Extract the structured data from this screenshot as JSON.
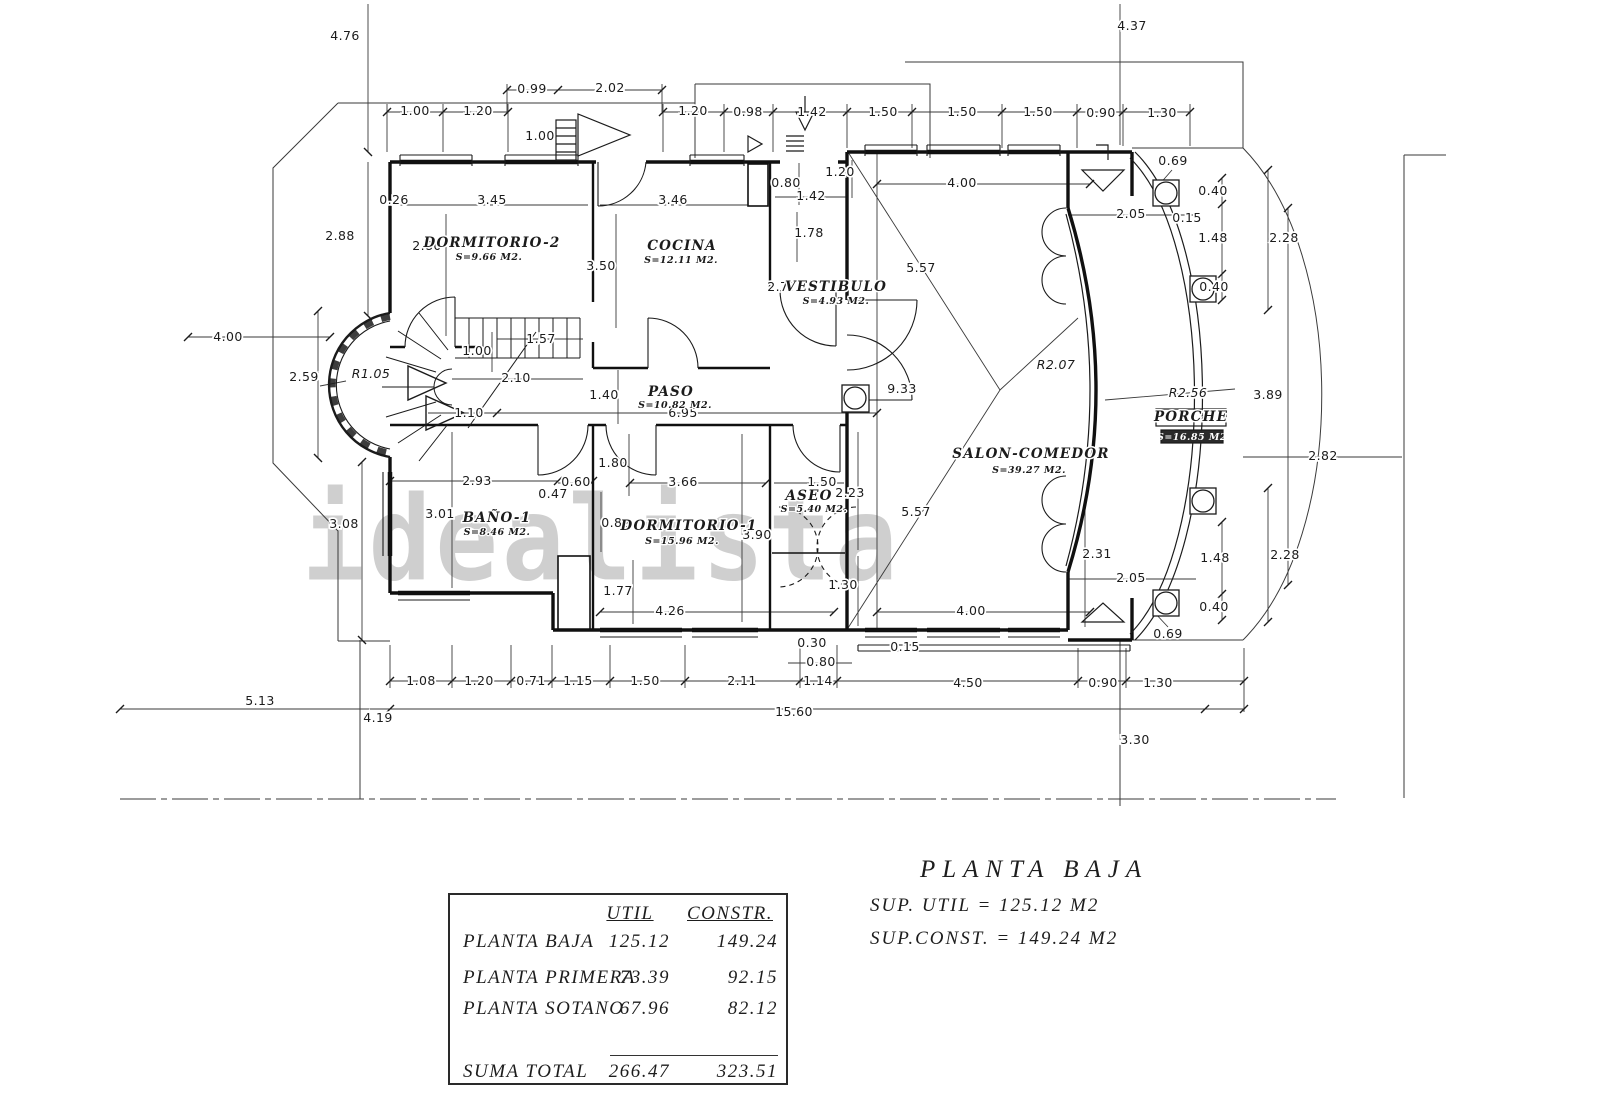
{
  "watermark": "idealista",
  "title_block": {
    "title": "PLANTA BAJA",
    "sup_util": "SUP. UTIL = 125.12 M2",
    "sup_const": "SUP.CONST. = 149.24 M2"
  },
  "summary_table": {
    "headers": {
      "util": "UTIL",
      "constr": "CONSTR."
    },
    "rows": [
      {
        "label": "PLANTA BAJA",
        "util": "125.12",
        "constr": "149.24"
      },
      {
        "label": "PLANTA PRIMERA",
        "util": "73.39",
        "constr": "92.15"
      },
      {
        "label": "PLANTA SOTANO",
        "util": "67.96",
        "constr": "82.12"
      }
    ],
    "total": {
      "label": "SUMA TOTAL",
      "util": "266.47",
      "constr": "323.51"
    }
  },
  "rooms": [
    {
      "name": "DORMITORIO-2",
      "area": "S=9.66 M2.",
      "x": 492,
      "y": 247,
      "ax": 489,
      "ay": 260
    },
    {
      "name": "COCINA",
      "area": "S=12.11 M2.",
      "x": 682,
      "y": 250,
      "ax": 681,
      "ay": 263
    },
    {
      "name": "VESTIBULO",
      "area": "S=4.93 M2.",
      "x": 836,
      "y": 291,
      "ax": 836,
      "ay": 304
    },
    {
      "name": "PASO",
      "area": "S=10.82 M2.",
      "x": 671,
      "y": 396,
      "ax": 675,
      "ay": 408
    },
    {
      "name": "BAÑO-1",
      "area": "S=8.46 M2.",
      "x": 497,
      "y": 522,
      "ax": 497,
      "ay": 535
    },
    {
      "name": "DORMITORIO-1",
      "area": "S=15.96 M2.",
      "x": 689,
      "y": 530,
      "ax": 682,
      "ay": 544
    },
    {
      "name": "ASEO",
      "area": "S=5.40 M2.",
      "x": 809,
      "y": 500,
      "ax": 814,
      "ay": 512
    },
    {
      "name": "SALON-COMEDOR",
      "area": "S=39.27 M2.",
      "x": 1031,
      "y": 458,
      "ax": 1029,
      "ay": 473
    },
    {
      "name": "PORCHE",
      "area": "S=16.85 M2",
      "x": 1191,
      "y": 421,
      "ax": 1192,
      "ay": 440
    }
  ],
  "annotations": [
    {
      "t": "R1.05",
      "x": 371,
      "y": 378
    },
    {
      "t": "R2.07",
      "x": 1056,
      "y": 369
    },
    {
      "t": "R2.56",
      "x": 1188,
      "y": 397
    }
  ],
  "dimensions": [
    {
      "t": "4.76",
      "x": 345,
      "y": 40
    },
    {
      "t": "4.37",
      "x": 1132,
      "y": 30
    },
    {
      "t": "0.99",
      "x": 532,
      "y": 93
    },
    {
      "t": "2.02",
      "x": 610,
      "y": 92
    },
    {
      "t": "1.00",
      "x": 415,
      "y": 115
    },
    {
      "t": "1.20",
      "x": 478,
      "y": 115
    },
    {
      "t": "1.20",
      "x": 693,
      "y": 115
    },
    {
      "t": "0.98",
      "x": 748,
      "y": 116
    },
    {
      "t": "1.42",
      "x": 812,
      "y": 116
    },
    {
      "t": "1.50",
      "x": 883,
      "y": 116
    },
    {
      "t": "1.50",
      "x": 962,
      "y": 116
    },
    {
      "t": "1.50",
      "x": 1038,
      "y": 116
    },
    {
      "t": "0.90",
      "x": 1101,
      "y": 117
    },
    {
      "t": "1.30",
      "x": 1162,
      "y": 117
    },
    {
      "t": "1.00",
      "x": 540,
      "y": 140
    },
    {
      "t": "0.80",
      "x": 786,
      "y": 187
    },
    {
      "t": "1.20",
      "x": 840,
      "y": 176
    },
    {
      "t": "1.42",
      "x": 811,
      "y": 200
    },
    {
      "t": "1.78",
      "x": 809,
      "y": 237
    },
    {
      "t": "2.77",
      "x": 782,
      "y": 291
    },
    {
      "t": "0.26",
      "x": 394,
      "y": 204
    },
    {
      "t": "3.45",
      "x": 492,
      "y": 204
    },
    {
      "t": "3.46",
      "x": 673,
      "y": 204
    },
    {
      "t": "2.80",
      "x": 427,
      "y": 250
    },
    {
      "t": "3.50",
      "x": 601,
      "y": 270
    },
    {
      "t": "2.88",
      "x": 340,
      "y": 240
    },
    {
      "t": "4.00",
      "x": 228,
      "y": 341
    },
    {
      "t": "2.59",
      "x": 304,
      "y": 381
    },
    {
      "t": "3.08",
      "x": 344,
      "y": 528
    },
    {
      "t": "1.57",
      "x": 541,
      "y": 343
    },
    {
      "t": "2.10",
      "x": 516,
      "y": 382
    },
    {
      "t": "1.00",
      "x": 477,
      "y": 355
    },
    {
      "t": "1.10",
      "x": 469,
      "y": 417
    },
    {
      "t": "1.40",
      "x": 604,
      "y": 399
    },
    {
      "t": "6.95",
      "x": 683,
      "y": 417
    },
    {
      "t": "9.33",
      "x": 902,
      "y": 393
    },
    {
      "t": "4.00",
      "x": 962,
      "y": 187
    },
    {
      "t": "4.00",
      "x": 971,
      "y": 615
    },
    {
      "t": "5.57",
      "x": 921,
      "y": 272
    },
    {
      "t": "5.57",
      "x": 916,
      "y": 516
    },
    {
      "t": "2.93",
      "x": 477,
      "y": 485
    },
    {
      "t": "0.60",
      "x": 576,
      "y": 486
    },
    {
      "t": "0.47",
      "x": 553,
      "y": 498
    },
    {
      "t": "3.01",
      "x": 440,
      "y": 518
    },
    {
      "t": "0.82",
      "x": 616,
      "y": 527
    },
    {
      "t": "1.80",
      "x": 613,
      "y": 467
    },
    {
      "t": "3.66",
      "x": 683,
      "y": 486
    },
    {
      "t": "3.90",
      "x": 757,
      "y": 539
    },
    {
      "t": "1.50",
      "x": 822,
      "y": 486
    },
    {
      "t": "2.23",
      "x": 850,
      "y": 497
    },
    {
      "t": "1.30",
      "x": 843,
      "y": 589
    },
    {
      "t": "1.77",
      "x": 618,
      "y": 595
    },
    {
      "t": "4.26",
      "x": 670,
      "y": 615
    },
    {
      "t": "0.30",
      "x": 812,
      "y": 647
    },
    {
      "t": "0.80",
      "x": 821,
      "y": 666
    },
    {
      "t": "0.15",
      "x": 905,
      "y": 651
    },
    {
      "t": "1.08",
      "x": 421,
      "y": 685
    },
    {
      "t": "1.20",
      "x": 479,
      "y": 685
    },
    {
      "t": "0.71",
      "x": 531,
      "y": 685
    },
    {
      "t": "1.15",
      "x": 578,
      "y": 685
    },
    {
      "t": "1.50",
      "x": 645,
      "y": 685
    },
    {
      "t": "2.11",
      "x": 742,
      "y": 685
    },
    {
      "t": "1.14",
      "x": 818,
      "y": 685
    },
    {
      "t": "4.50",
      "x": 968,
      "y": 687
    },
    {
      "t": "0.90",
      "x": 1103,
      "y": 687
    },
    {
      "t": "1.30",
      "x": 1158,
      "y": 687
    },
    {
      "t": "5.13",
      "x": 260,
      "y": 705
    },
    {
      "t": "4.19",
      "x": 378,
      "y": 722
    },
    {
      "t": "15.60",
      "x": 794,
      "y": 716
    },
    {
      "t": "3.30",
      "x": 1135,
      "y": 744
    },
    {
      "t": "0.69",
      "x": 1173,
      "y": 165
    },
    {
      "t": "0.69",
      "x": 1168,
      "y": 638
    },
    {
      "t": "2.05",
      "x": 1131,
      "y": 218
    },
    {
      "t": "2.05",
      "x": 1131,
      "y": 582
    },
    {
      "t": "0.15",
      "x": 1187,
      "y": 222
    },
    {
      "t": "0.40",
      "x": 1213,
      "y": 195
    },
    {
      "t": "1.48",
      "x": 1213,
      "y": 242
    },
    {
      "t": "0.40",
      "x": 1214,
      "y": 291
    },
    {
      "t": "2.28",
      "x": 1284,
      "y": 242
    },
    {
      "t": "0.40",
      "x": 1214,
      "y": 611
    },
    {
      "t": "1.48",
      "x": 1215,
      "y": 562
    },
    {
      "t": "2.28",
      "x": 1285,
      "y": 559
    },
    {
      "t": "2.31",
      "x": 1097,
      "y": 558
    },
    {
      "t": "3.89",
      "x": 1268,
      "y": 399
    },
    {
      "t": "2.82",
      "x": 1323,
      "y": 460
    }
  ]
}
